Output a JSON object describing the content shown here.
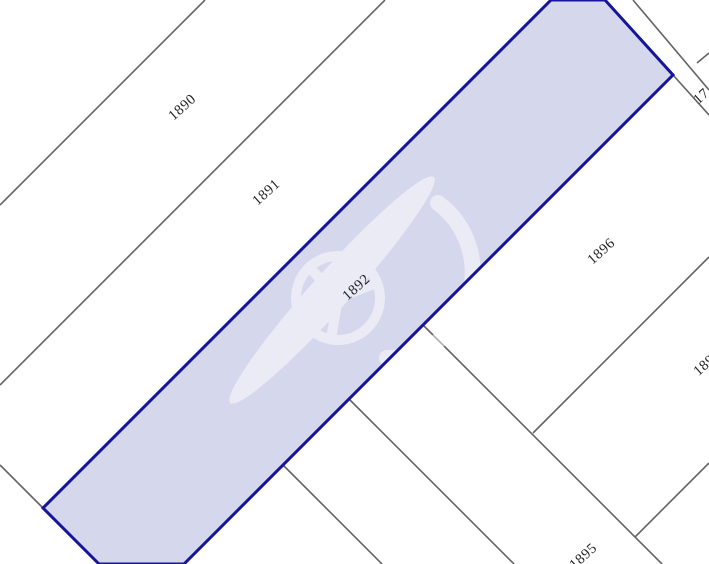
{
  "map": {
    "type": "cadastral-parcel-map",
    "selected_parcel": "1892",
    "colors": {
      "background": "#ffffff",
      "boundary_line": "#636363",
      "highlight_fill": "#d5d7ec",
      "highlight_border": "#15159b",
      "label": "#1f1f1f",
      "watermark": "#ffffff"
    },
    "labels": [
      {
        "text": "1890",
        "partially_visible": false
      },
      {
        "text": "1891",
        "partially_visible": false
      },
      {
        "text": "1892",
        "partially_visible": false
      },
      {
        "text": "1896",
        "partially_visible": false
      },
      {
        "text": "1895",
        "partially_visible": true
      },
      {
        "text": "17",
        "partially_visible": true
      },
      {
        "text": "189",
        "partially_visible": true
      }
    ]
  }
}
